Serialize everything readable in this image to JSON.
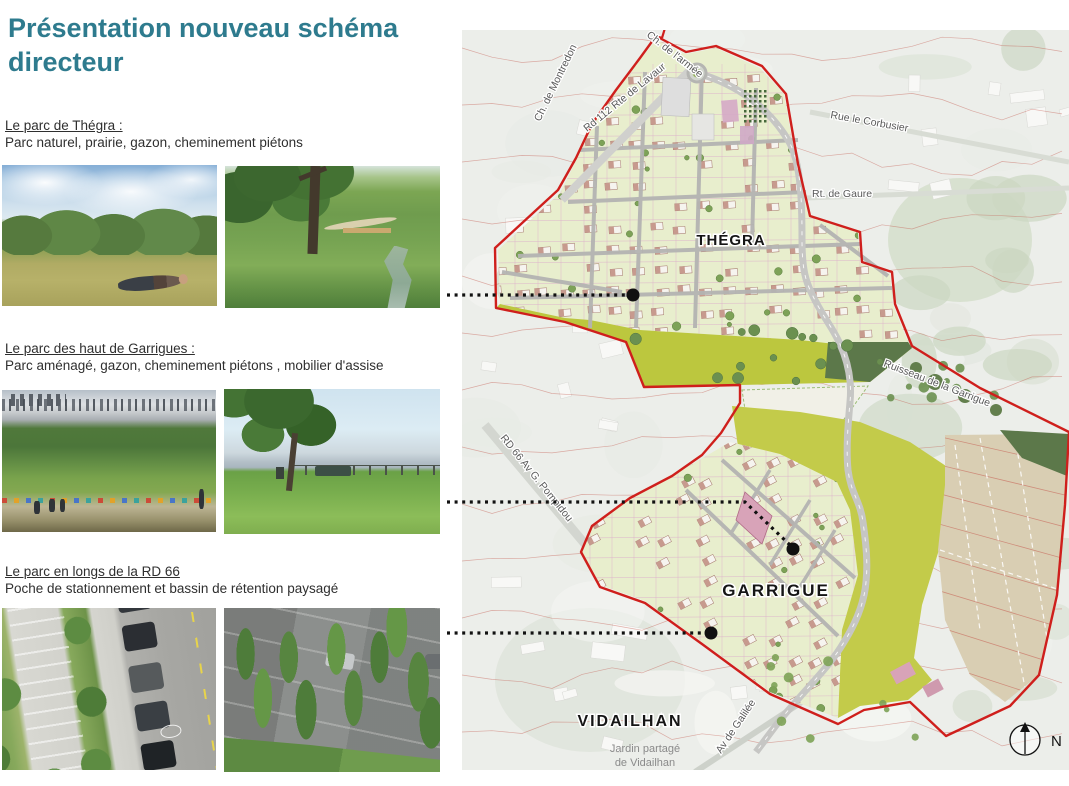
{
  "title": "Présentation nouveau schéma directeur",
  "accent_color": "#2e7b8e",
  "sections": [
    {
      "heading": "Le parc de Thégra : ",
      "description": "Parc naturel, prairie, gazon, cheminement piétons"
    },
    {
      "heading": "Le parc des haut de Garrigues :",
      "description": "Parc aménagé, gazon, cheminement piétons , mobilier d'assise"
    },
    {
      "heading": "Le parc en longs de la RD 66",
      "description": "Poche de stationnement et bassin de rétention paysagé"
    }
  ],
  "map": {
    "labels": {
      "thegra": "THÉGRA",
      "garrigue": "GARRIGUE",
      "vidailhan": "VIDAILHAN",
      "jardin_line1": "Jardin partagé",
      "jardin_line2": "de Vidailhan",
      "road_armee": "Ch. de l'armée",
      "road_montredon": "Ch. de Montredon",
      "road_lavaur": "Rd 112 Rte de Lavaur",
      "road_corbusier": "Rue le Corbusier",
      "road_gaure": "Rt. de Gaure",
      "road_pompidou": "RD 66 Av G. Pompidou",
      "road_galilee": "Av de Galilée",
      "stream": "Ruisseau de la Garrigue",
      "north": "N"
    },
    "icons": {
      "north_arrow": "north-arrow-icon"
    },
    "colors": {
      "boundary": "#cf1f1c",
      "contour": "#c4574c",
      "urban_parcel": "#e8eecd",
      "olive_park": "#bcc73e",
      "big_field_olive": "#c3cb4a",
      "farm_field": "#d9ceb3",
      "woods": "#5c784a",
      "road": "#c6c6c4",
      "title": "#2e7b8e"
    }
  }
}
